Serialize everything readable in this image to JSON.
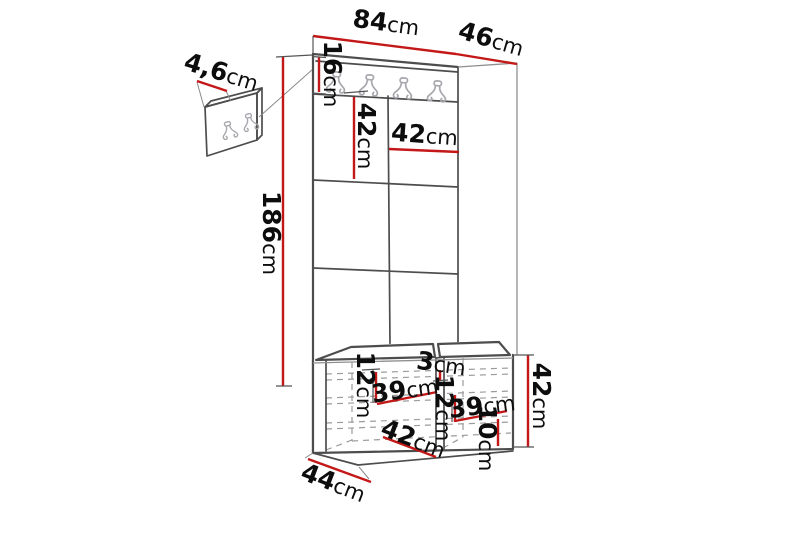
{
  "diagram_title": "hallway-unit-dimension-diagram",
  "colors": {
    "red": "#c41818",
    "line": "#4d4d4d",
    "dash": "#9b9b9b",
    "hook": "#a7a7ad",
    "txt": "#0d0d0d",
    "bg": "#ffffff"
  },
  "dims": {
    "small_panel_thickness": {
      "num": "4,6",
      "unit": "cm"
    },
    "total_width": {
      "num": "84",
      "unit": "cm"
    },
    "total_depth": {
      "num": "46",
      "unit": "cm"
    },
    "rail_height": {
      "num": "16",
      "unit": "cm"
    },
    "panel_height": {
      "num": "42",
      "unit": "cm"
    },
    "panel_width": {
      "num": "42",
      "unit": "cm"
    },
    "total_height": {
      "num": "186",
      "unit": "cm"
    },
    "bench_left_inner_height": {
      "num": "12",
      "unit": "cm"
    },
    "bench_left_inner_width": {
      "num": "39",
      "unit": "cm"
    },
    "bench_divider_thickness": {
      "num": "3",
      "unit": "cm"
    },
    "bench_right_inner_height": {
      "num": "12",
      "unit": "cm"
    },
    "bench_right_inner_width": {
      "num": "39",
      "unit": "cm"
    },
    "bench_plinth_height": {
      "num": "10",
      "unit": "cm"
    },
    "bench_height": {
      "num": "42",
      "unit": "cm"
    },
    "bench_inner_depth": {
      "num": "42",
      "unit": "cm"
    },
    "bench_depth": {
      "num": "44",
      "unit": "cm"
    }
  }
}
